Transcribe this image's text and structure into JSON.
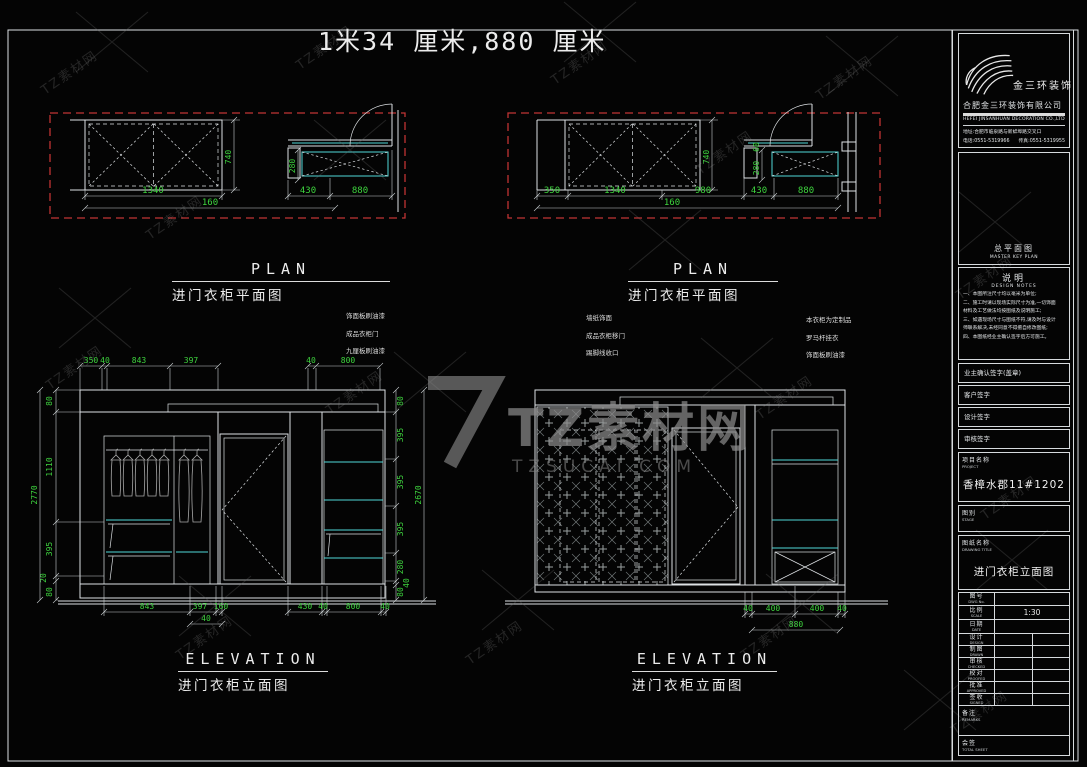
{
  "page": {
    "title": "1米34 厘米,880 厘米"
  },
  "watermark": {
    "tile": "TZ素材网",
    "center": "TZ素材网",
    "domain": "TZSUCAI.COM"
  },
  "labels": {
    "plan_en": "PLAN",
    "plan_cn": "进门衣柜平面图",
    "elev_en": "ELEVATION",
    "elev_cn": "进门衣柜立面图"
  },
  "plan_left": {
    "d1340": "1340",
    "d740": "740",
    "d430": "430",
    "d880": "880",
    "d280": "280",
    "d160": "160"
  },
  "plan_right": {
    "d350": "350",
    "d1340": "1340",
    "d980": "980",
    "d430": "430",
    "d880": "880",
    "d740": "740",
    "d280": "280",
    "d60": "60",
    "d160": "160"
  },
  "elev_left": {
    "top": [
      "350",
      "40",
      "843",
      "397",
      "40",
      "800"
    ],
    "left": [
      "80",
      "1110",
      "395",
      "20",
      "80"
    ],
    "left_total": "2770",
    "right": [
      "80",
      "395",
      "395",
      "395",
      "280",
      "40",
      "80"
    ],
    "right_total": "2670",
    "bottom": [
      "843",
      "397",
      "160",
      "40"
    ],
    "bottom_right": [
      "430",
      "40",
      "800",
      "40"
    ],
    "notes": [
      "饰面板刷油漆",
      "成品衣柜门",
      "九厘板刷油漆"
    ]
  },
  "elev_right": {
    "bottom": [
      "40",
      "400",
      "400",
      "40"
    ],
    "bottom_total": "880",
    "notes_left": [
      "墙纸饰面",
      "成品衣柜移门",
      "踢脚线收口"
    ],
    "notes_right": [
      "本衣柜为定制品",
      "罗马杆挂衣",
      "饰面板刷油漆"
    ]
  },
  "titleblock": {
    "brand": "金三环装饰",
    "company_cn": "合肥金三环装饰有限公司",
    "company_en": "HEFEI JINSANHUAN DECORATION CO.,LTD",
    "address": "地址:合肥市临泉路与新蚌埠路交叉口",
    "phone": "电话:0551-5319966",
    "fax": "传真:0551-5319955",
    "keyplan_cn": "总平面图",
    "keyplan_en": "MASTER KEY PLAN",
    "notes_cn": "说明",
    "notes_en": "DESIGN NOTES",
    "notes_lines": [
      "一、本图所注尺寸均以毫米为单位;",
      "二、施工时请以现场实际尺寸为准,一切饰面",
      "材料及工艺做法均按图纸及说明施工;",
      "三、如遇现场尺寸与图纸不符,请及时与设计",
      "师联系解决,未经同意不得擅自修改图纸;",
      "四、本图纸经业主确认签字后方可施工。"
    ],
    "sign_rows": [
      "业主确认签字(盖章)",
      "客户签字",
      "设计签字",
      "审核签字"
    ],
    "project_cn": "项目名称",
    "project_en": "PROJECT",
    "project_value": "香樟水郡11#1202",
    "stage_cn": "图别",
    "stage_en": "STAGE",
    "stage_value": "",
    "dwg_cn": "图纸名称",
    "dwg_en": "DRAWING TITLE",
    "dwg_value": "进门衣柜立面图",
    "rows": [
      {
        "cn": "图号",
        "en": "DWG No.",
        "value": ""
      },
      {
        "cn": "比例",
        "en": "SCALE",
        "value": "1:30"
      },
      {
        "cn": "日期",
        "en": "DATE",
        "value": ""
      },
      {
        "cn": "设计",
        "en": "DESIGN",
        "value": ""
      },
      {
        "cn": "制图",
        "en": "DRAWN",
        "value": ""
      },
      {
        "cn": "审核",
        "en": "CHECKED",
        "value": ""
      },
      {
        "cn": "校对",
        "en": "PROOFED",
        "value": ""
      },
      {
        "cn": "批准",
        "en": "APPROVED",
        "value": ""
      },
      {
        "cn": "签收",
        "en": "SIGNED",
        "value": ""
      }
    ],
    "remark_cn": "备注",
    "remark_en": "REMARKS",
    "file_cn": "会签",
    "file_en": "TOTAL SHEET"
  }
}
